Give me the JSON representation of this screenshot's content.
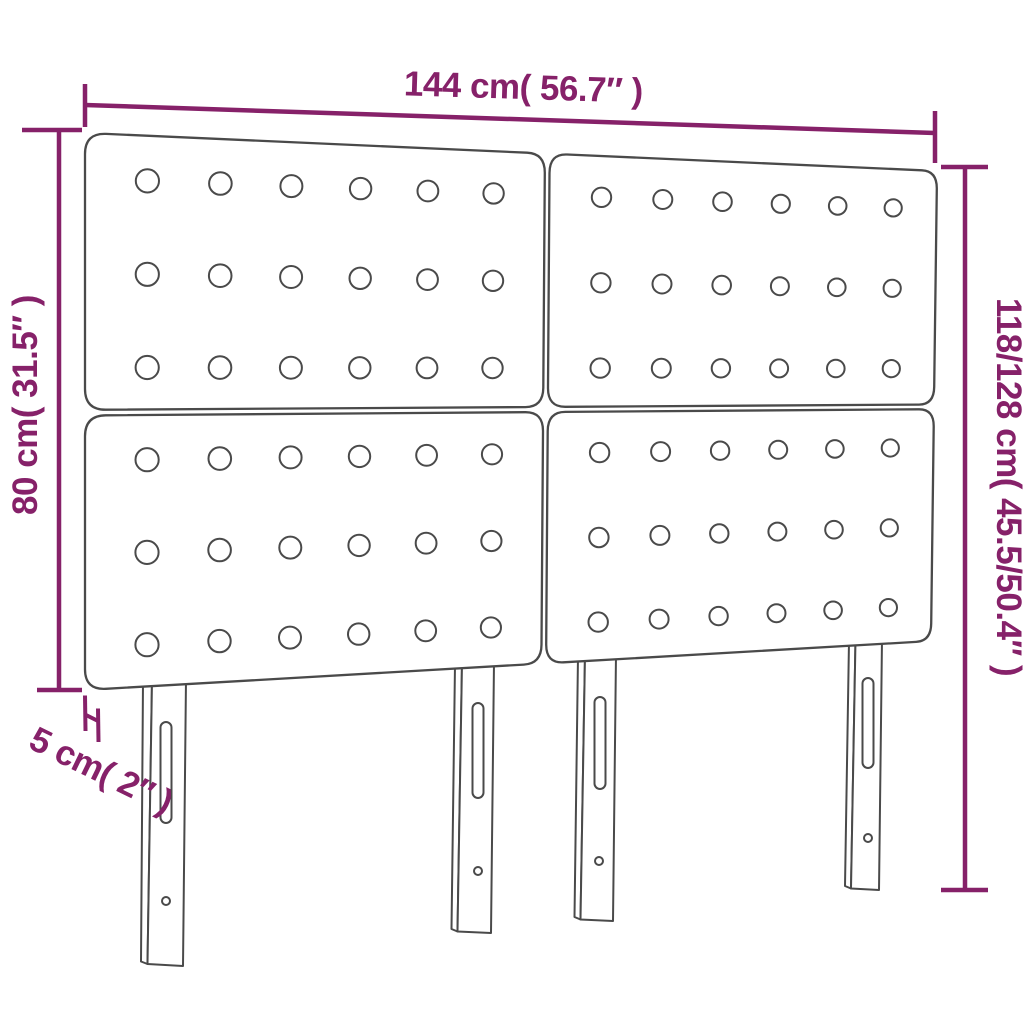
{
  "title": "Headboard dimension diagram",
  "dimensions": {
    "width": {
      "label": "144 cm( 56.7″ )",
      "cm": "144",
      "inch": "56.7"
    },
    "panel_height": {
      "label": "80 cm( 31.5″ )",
      "cm": "80",
      "inch": "31.5"
    },
    "total_height": {
      "label": "118/128 cm( 45.5/50.4″ )",
      "cm": "118/128",
      "inch": "45.5/50.4"
    },
    "depth": {
      "label": "5 cm( 2″ )",
      "cm": "5",
      "inch": "2"
    }
  },
  "diagram": {
    "subject": "upholstered headboard",
    "panels": 4,
    "button_grid_per_panel": "6 x 3",
    "buttons_per_panel": 18,
    "buttons_total": 72,
    "legs": 4
  },
  "colors": {
    "dimension_accent": "#862169",
    "outline": "#4a4a4a",
    "background": "#ffffff"
  }
}
